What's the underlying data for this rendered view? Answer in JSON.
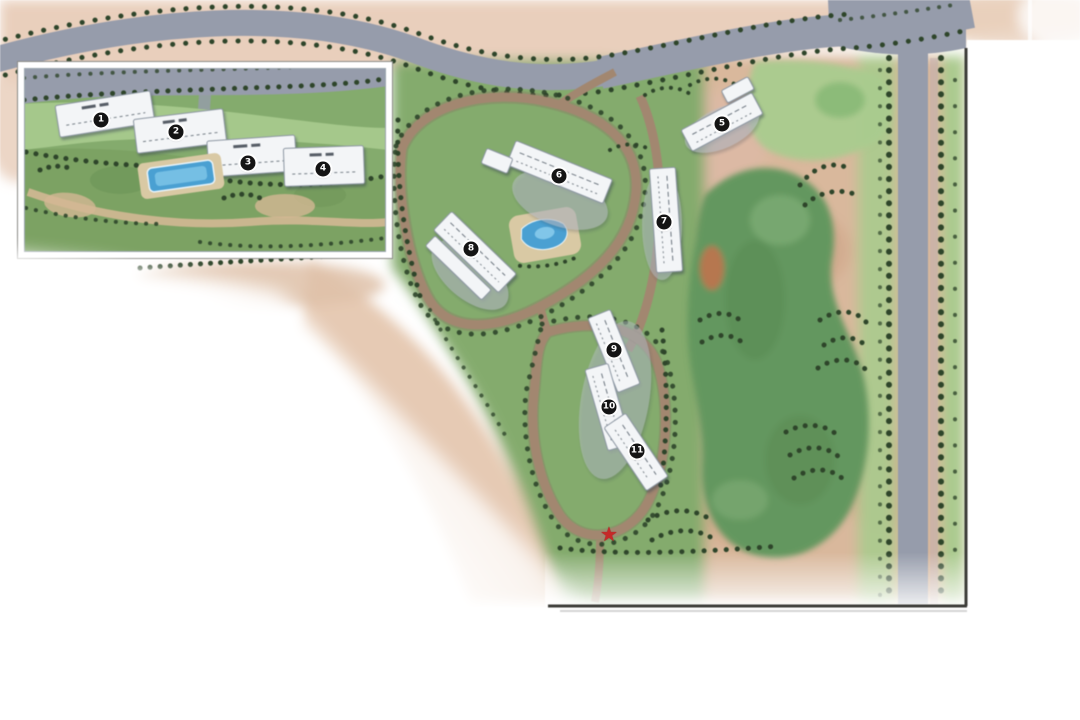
{
  "map": {
    "description_markers_note": "numbered building markers on a residential golf-community master plan",
    "palette": {
      "terrain_pink": "#e9cfbc",
      "terrain_tan": "#d9b89c",
      "road_gray": "#969cab",
      "road_brown": "#a28770",
      "green_base": "#84ab6d",
      "green_light": "#a9cb8e",
      "fairway_green": "#64975f",
      "tree_dark": "#2e452a",
      "pool_blue": "#4aa0d2",
      "building_white": "#f3f5f7",
      "marker_black": "#141414",
      "star_red": "#c62828",
      "border_dark": "#3c3c38",
      "inset_border": "#ffffff"
    },
    "inset": {
      "markers": [
        {
          "label": "1",
          "x": 101,
          "y": 120
        },
        {
          "label": "2",
          "x": 176,
          "y": 132
        },
        {
          "label": "3",
          "x": 248,
          "y": 163
        },
        {
          "label": "4",
          "x": 323,
          "y": 169
        }
      ]
    },
    "main": {
      "markers": [
        {
          "label": "5",
          "x": 722,
          "y": 124
        },
        {
          "label": "6",
          "x": 559,
          "y": 176
        },
        {
          "label": "7",
          "x": 664,
          "y": 222
        },
        {
          "label": "8",
          "x": 471,
          "y": 249
        },
        {
          "label": "9",
          "x": 614,
          "y": 350
        },
        {
          "label": "10",
          "x": 609,
          "y": 407
        },
        {
          "label": "11",
          "x": 637,
          "y": 451
        }
      ]
    },
    "star": {
      "glyph": "★",
      "x": 609,
      "y": 534
    }
  }
}
